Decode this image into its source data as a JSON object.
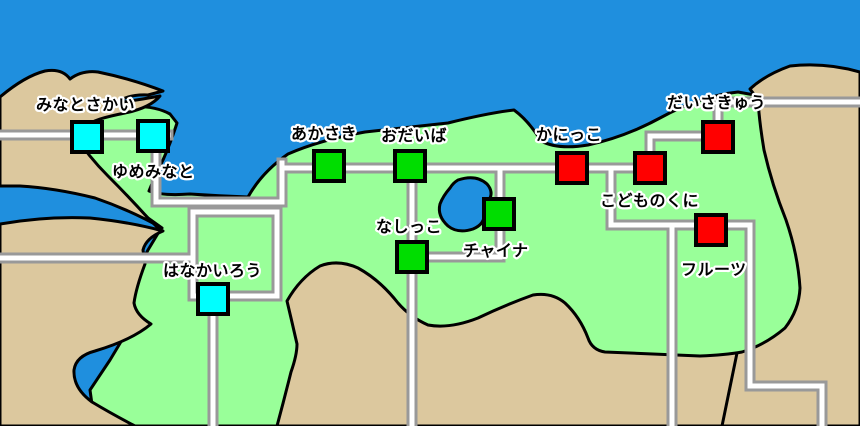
{
  "map": {
    "stations": [
      {
        "name": "みなとさかい",
        "color_key": "cyan",
        "cx": 87,
        "cy": 137,
        "label_x": 36,
        "label_y": 110
      },
      {
        "name": "ゆめみなと",
        "color_key": "cyan",
        "cx": 153,
        "cy": 136,
        "label_x": 112,
        "label_y": 177
      },
      {
        "name": "あかさき",
        "color_key": "green",
        "cx": 329,
        "cy": 166,
        "label_x": 291,
        "label_y": 139
      },
      {
        "name": "おだいば",
        "color_key": "green",
        "cx": 410,
        "cy": 166,
        "label_x": 381,
        "label_y": 141
      },
      {
        "name": "なしっこ",
        "color_key": "green",
        "cx": 412,
        "cy": 257,
        "label_x": 376,
        "label_y": 232
      },
      {
        "name": "チャイナ",
        "color_key": "green",
        "cx": 499,
        "cy": 214,
        "label_x": 463,
        "label_y": 256
      },
      {
        "name": "かにっこ",
        "color_key": "red",
        "cx": 572,
        "cy": 168,
        "label_x": 536,
        "label_y": 140
      },
      {
        "name": "こどものくに",
        "color_key": "red",
        "cx": 650,
        "cy": 168,
        "label_x": 600,
        "label_y": 206
      },
      {
        "name": "だいさきゅう",
        "color_key": "red",
        "cx": 718,
        "cy": 137,
        "label_x": 667,
        "label_y": 108
      },
      {
        "name": "フルーツ",
        "color_key": "red",
        "cx": 711,
        "cy": 230,
        "label_x": 681,
        "label_y": 275
      },
      {
        "name": "はなかいろう",
        "color_key": "cyan",
        "cx": 213,
        "cy": 299,
        "label_x": 163,
        "label_y": 276
      }
    ],
    "station_colors": {
      "cyan": "#00FFFF",
      "green": "#00DD00",
      "red": "#FF0000"
    },
    "terrain_colors": {
      "ocean": "#1F8FDE",
      "land": "#99FF99",
      "sand": "#DCC89E",
      "lake": "#2090DF",
      "road_core": "#FFFFFF",
      "road_casing": "#999999",
      "outline": "#000000"
    }
  }
}
